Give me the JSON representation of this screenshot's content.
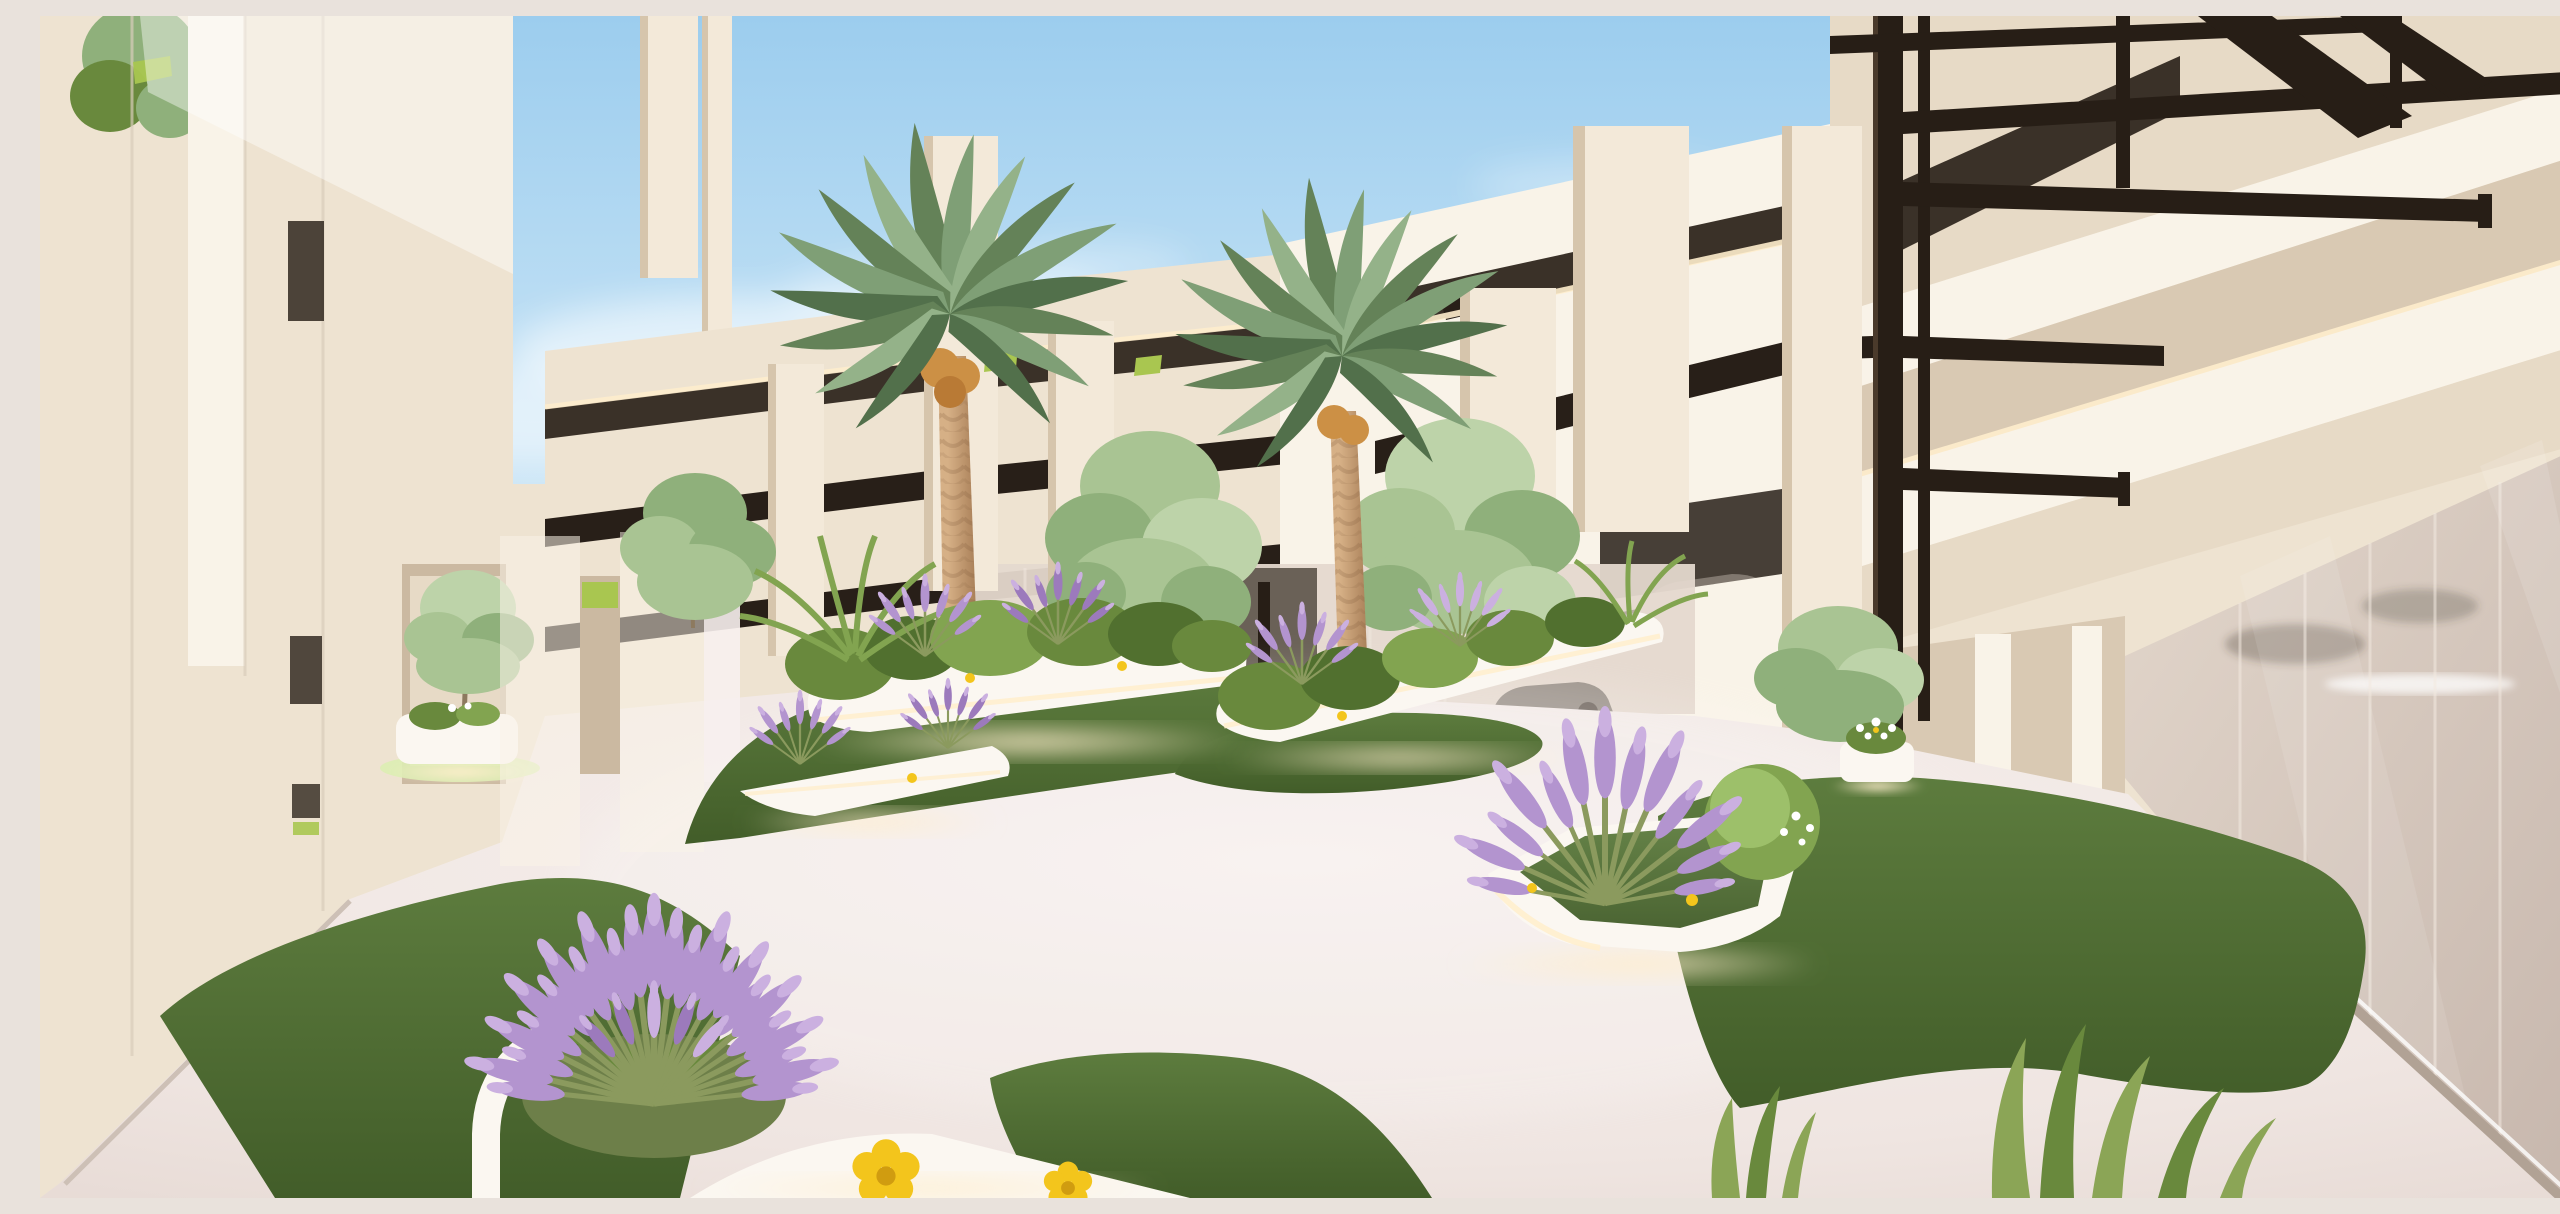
{
  "meta": {
    "title": "Courtyard architectural rendering",
    "media_type": "3D architectural render, no visible text or UI controls",
    "width_px": 2560,
    "height_px": 1182
  },
  "scene": {
    "description": "Daylight 3D architectural rendering of a modern white residential courtyard: two tall date palms and light deciduous trees rise from sculptural white illuminated planters set on organic artificial-grass islands over pale pink-white paving; the background is a cream parking-structure facade with staggered hanging vertical fins, dark recessed floor slots with warm cove lighting and lime-green accents; on the right a black steel frame of slender columns and cantilevered beams stands in front of a warm reflective glass curtain wall with cars visible behind it; a large lavender bush with yellow poppies fills the left foreground and grass blades enter the bottom-right corner.",
    "sky": "clear light-blue sky with soft white clouds near the rooflines",
    "ground": "pale pink-white resin paving with organic dark-green lawn islands",
    "lighting": "soft daylight with warm under-glow strips beneath planters and ceiling coves",
    "landmarks": [
      {
        "name": "left-building",
        "desc": "tall cream concrete walls with vertical fins, recessed dark slots and a lime accent stripe"
      },
      {
        "name": "arcade",
        "desc": "ground-level wall openings with a small tree, a white planter and a pale lawn inside"
      },
      {
        "name": "parking-structure",
        "desc": "cream facade with staggered hanging fins, dark floor slots, warm cove light and lime-green louver accents"
      },
      {
        "name": "palm-tree-left",
        "desc": "tall date palm with textured trunk and orange date cluster"
      },
      {
        "name": "palm-tree-right",
        "desc": "tall date palm with textured trunk"
      },
      {
        "name": "steel-frame",
        "desc": "black steel columns with cantilevered beams and braces on the right side"
      },
      {
        "name": "tall-white-pillar",
        "desc": "full-height white concrete pillar beside the steel columns"
      },
      {
        "name": "glass-facade",
        "desc": "warm reflective curtain wall, interior glow strip and parked-car reflections"
      },
      {
        "name": "planters",
        "desc": "white organic planters with under-lighting, holding lavender, shrub mounds and ornamental grasses"
      },
      {
        "name": "grass-islands",
        "desc": "five organic dark-green lawn shapes"
      },
      {
        "name": "foreground-lavender-bush",
        "desc": "large fanned lavender shrub in a white rimmed planter"
      },
      {
        "name": "yellow-poppies",
        "desc": "two small yellow poppy flowers near the foreground planter"
      },
      {
        "name": "grass-blades",
        "desc": "long leaf blades entering the bottom-right foreground"
      }
    ]
  },
  "vegetation_inventory": {
    "date_palms": 2,
    "ornamental_trees": 5,
    "lavender_clusters": 8,
    "shrub_mounds": 9,
    "grass_islands": 5,
    "yellow_poppies": 2
  },
  "colors": {
    "sky_top": "#9ccdee",
    "sky_mid": "#c8e4f6",
    "sky_low": "#edf6fb",
    "cloud_white": "#ffffff",
    "wall_lit": "#f9f3e8",
    "wall_base": "#eee3d1",
    "wall_mid": "#e7dac6",
    "wall_shadow": "#d9c9b3",
    "wall_deep": "#cbb9a1",
    "fin_face": "#f3e9d9",
    "fin_shadow": "#d6c5ac",
    "slot_dark": "#3a3128",
    "slot_deep": "#281f18",
    "glow_warm": "#ffeecd",
    "lime_accent": "#a9c650",
    "glass_light": "#e3d7cc",
    "glass_dark": "#c6b6ac",
    "steel": "#271e16",
    "steel_hi": "#4a3a2b",
    "pave_light": "#f7f0ee",
    "pave_mid": "#efe5e1",
    "pave_dark": "#e5d8d2",
    "curb": "#cdc0b6",
    "sill": "#b1a295",
    "grass_light": "#5d7c3e",
    "grass_dark": "#425d29",
    "grass_pale": "#dcedb2",
    "trunk_light": "#d6b086",
    "trunk_dark": "#a67c55",
    "date_fruit": "#cc9045",
    "palm_green_1": "#7f9f76",
    "palm_green_2": "#648258",
    "palm_green_3": "#94b289",
    "palm_green_4": "#52704b",
    "tree_green_1": "#a9c493",
    "tree_green_2": "#8fb07b",
    "tree_green_3": "#bdd3a9",
    "bush_dark": "#51702f",
    "bush_mid": "#69893d",
    "bush_light": "#82a450",
    "lavender_1": "#b394cf",
    "lavender_2": "#9c7abc",
    "lavender_3": "#cbb0e0",
    "stem_green": "#8b9a5e",
    "flower_yellow": "#f3c51c",
    "flower_center": "#d09c10",
    "white_planter": "#fbf7f1",
    "planter_shadow": "#e2d7c9",
    "blade_green": "#8ba556",
    "car_dark": "#3f3833",
    "car_silver": "#8a8178"
  }
}
